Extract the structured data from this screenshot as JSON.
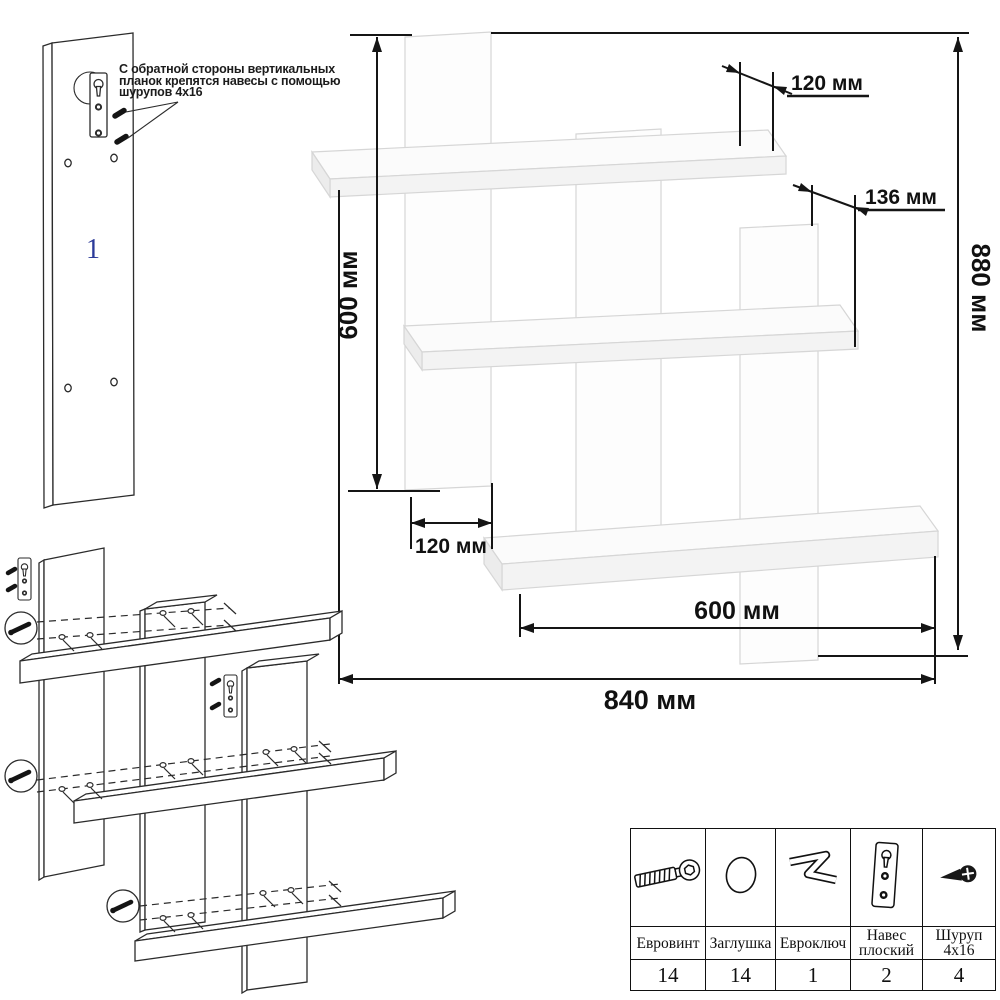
{
  "figure_plank": {
    "part_number": "1"
  },
  "annotation": {
    "line1": "С обратной стороны вертикальных",
    "line2": "планок крепятся навесы с помощью",
    "line3": "шурупов 4x16"
  },
  "dimensions": {
    "top_plank_offset": "120 мм",
    "right_plank_offset": "136 мм",
    "left_plank_height": "600 мм",
    "total_height": "880 мм",
    "plank_width": "120 мм",
    "shelf_length": "600 мм",
    "total_width": "840 мм"
  },
  "parts_table": {
    "items": [
      {
        "name": "Евровинт",
        "qty": "14",
        "icon": "euro-screw-icon"
      },
      {
        "name": "Заглушка",
        "qty": "14",
        "icon": "cap-icon"
      },
      {
        "name": "Евроключ",
        "qty": "1",
        "icon": "hex-key-icon"
      },
      {
        "name": "Навес плоский",
        "qty": "2",
        "icon": "flat-hanger-icon"
      },
      {
        "name": "Шуруп 4x16",
        "qty": "4",
        "icon": "screw-4x16-icon"
      }
    ]
  },
  "colors": {
    "part_number_blue": "#2b3a99",
    "line_black": "#151515"
  }
}
